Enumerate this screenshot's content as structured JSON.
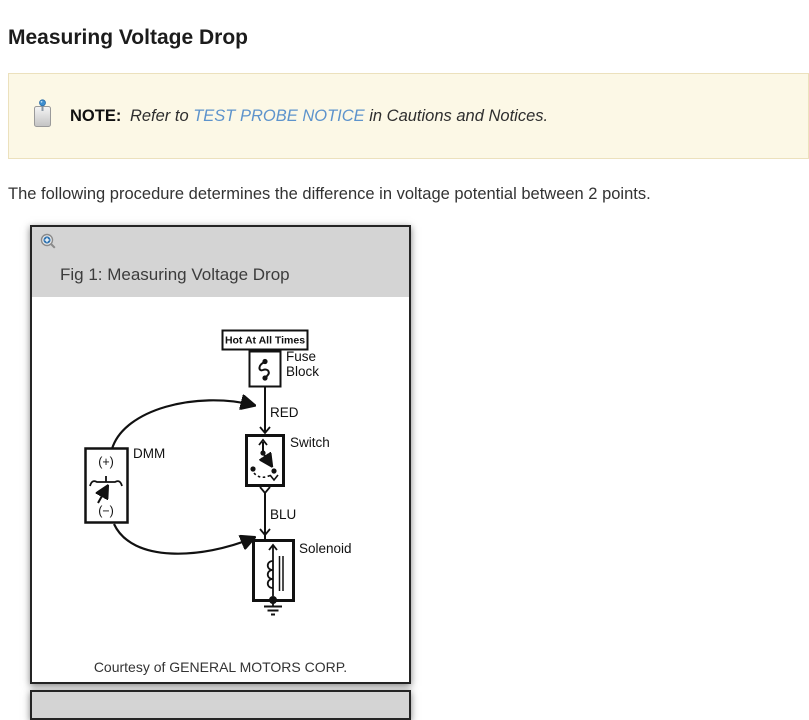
{
  "page": {
    "title": "Measuring Voltage Drop",
    "intro": "The following procedure determines the difference in voltage potential between 2 points."
  },
  "note": {
    "label": "NOTE:",
    "before_link": "Refer to ",
    "link_text": "TEST PROBE NOTICE",
    "after_link": " in Cautions and Notices.",
    "icon": "note-pin-icon"
  },
  "figure": {
    "caption": "Fig 1: Measuring Voltage Drop",
    "zoom_icon": "zoom-in-icon",
    "credit": "Courtesy of GENERAL MOTORS CORP.",
    "labels": {
      "hot": "Hot At All Times",
      "fuse_line1": "Fuse",
      "fuse_line2": "Block",
      "wire_top": "RED",
      "switch": "Switch",
      "wire_bottom": "BLU",
      "solenoid": "Solenoid",
      "meter": "DMM",
      "meter_plus": "(+)",
      "meter_minus": "(−)"
    }
  },
  "colors": {
    "note_background": "#fcf8e6",
    "note_border": "#ece1bd",
    "link": "#5d93cc",
    "figure_header_background": "#d4d4d4",
    "diagram_ink": "#111111"
  }
}
